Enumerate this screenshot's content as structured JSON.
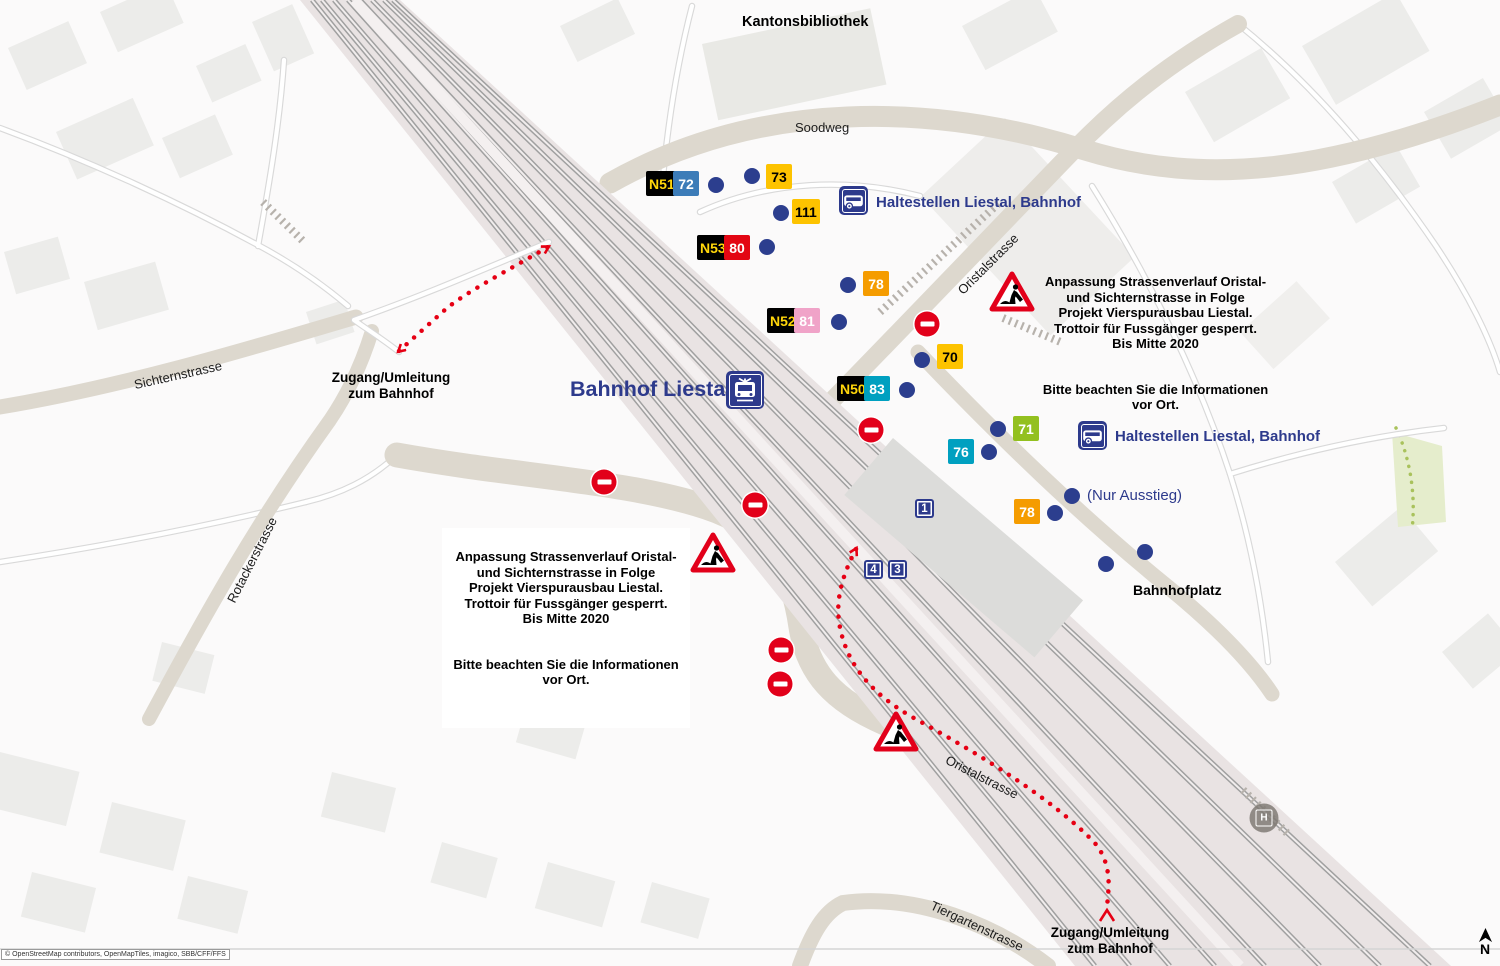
{
  "page": {
    "copyright": "© OpenStreetMap contributors, OpenMapTiles, imagico, SBB/CFF/FFS",
    "north": "N",
    "h_stop": "H"
  },
  "station": {
    "name": "Bahnhof Liestal"
  },
  "halts": {
    "label": "Haltestellen Liestal, Bahnhof",
    "exit_only": "(Nur Ausstieg)"
  },
  "streets": {
    "kantonsbibliothek": "Kantonsbibliothek",
    "soodweg": "Soodweg",
    "sichternstrasse": "Sichternstrasse",
    "rotackerstrasse": "Rotackerstrasse",
    "oristalstrasse": "Oristalstrasse",
    "tiergartenstrasse": "Tiergartenstrasse",
    "bahnhofplatz": "Bahnhofplatz"
  },
  "notice": {
    "body": "Anpassung Strassenverlauf Oristal-\nund Sichternstrasse in Folge\nProjekt Vierspurausbau Liestal.\nTrottoir für Fussgänger gesperrt.\nBis Mitte 2020",
    "footer": "Bitte beachten Sie die Informationen\nvor Ort."
  },
  "detour": {
    "label": "Zugang/Umleitung\nzum Bahnhof"
  },
  "colors": {
    "navy": "#2d3a8c",
    "red": "#e2001a",
    "yellow": "#fdc300",
    "orange": "#f59c00",
    "blue": "#3c7cb8",
    "teal": "#00a0c0",
    "green": "#93c01f",
    "pink": "#f0a3c8",
    "badge_black": "#000000",
    "badge_yellow_text": "#ffd60a"
  },
  "stop_badges": [
    {
      "label": "N51",
      "x": 646,
      "y": 171,
      "bg": "#000000",
      "fg": "#ffd60a"
    },
    {
      "label": "72",
      "x": 673,
      "y": 171,
      "bg": "#3c7cb8",
      "fg": "#ffffff"
    },
    {
      "label": "73",
      "x": 766,
      "y": 164,
      "bg": "#fdc300",
      "fg": "#000000"
    },
    {
      "label": "111",
      "x": 792,
      "y": 199,
      "bg": "#fdc300",
      "fg": "#000000"
    },
    {
      "label": "N53",
      "x": 697,
      "y": 235,
      "bg": "#000000",
      "fg": "#ffd60a"
    },
    {
      "label": "80",
      "x": 724,
      "y": 235,
      "bg": "#e30613",
      "fg": "#ffffff"
    },
    {
      "label": "78",
      "x": 863,
      "y": 271,
      "bg": "#f59c00",
      "fg": "#ffffff"
    },
    {
      "label": "N52",
      "x": 767,
      "y": 308,
      "bg": "#000000",
      "fg": "#ffd60a"
    },
    {
      "label": "81",
      "x": 794,
      "y": 308,
      "bg": "#f0a3c8",
      "fg": "#ffffff"
    },
    {
      "label": "70",
      "x": 937,
      "y": 344,
      "bg": "#fdc300",
      "fg": "#000000"
    },
    {
      "label": "N50",
      "x": 837,
      "y": 376,
      "bg": "#000000",
      "fg": "#ffd60a"
    },
    {
      "label": "83",
      "x": 864,
      "y": 376,
      "bg": "#00a0c0",
      "fg": "#ffffff"
    },
    {
      "label": "71",
      "x": 1013,
      "y": 416,
      "bg": "#93c01f",
      "fg": "#ffffff"
    },
    {
      "label": "76",
      "x": 948,
      "y": 439,
      "bg": "#00a0c0",
      "fg": "#ffffff"
    },
    {
      "label": "78",
      "x": 1014,
      "y": 499,
      "bg": "#f59c00",
      "fg": "#ffffff"
    }
  ],
  "platform_badges": [
    {
      "label": "1",
      "x": 915,
      "y": 499
    },
    {
      "label": "4",
      "x": 864,
      "y": 560
    },
    {
      "label": "3",
      "x": 888,
      "y": 560
    }
  ],
  "stop_dots": [
    [
      716,
      185
    ],
    [
      752,
      176
    ],
    [
      781,
      213
    ],
    [
      767,
      247
    ],
    [
      848,
      285
    ],
    [
      839,
      322
    ],
    [
      922,
      360
    ],
    [
      907,
      390
    ],
    [
      998,
      429
    ],
    [
      989,
      452
    ],
    [
      1072,
      496
    ],
    [
      1055,
      513
    ],
    [
      1106,
      564
    ],
    [
      1145,
      552
    ]
  ],
  "no_entry_signs": [
    [
      927,
      324
    ],
    [
      871,
      430
    ],
    [
      604,
      482
    ],
    [
      755,
      505
    ],
    [
      781,
      650
    ],
    [
      780,
      684
    ]
  ],
  "construction_signs": [
    [
      1012,
      292
    ],
    [
      713,
      553
    ],
    [
      896,
      732
    ]
  ]
}
